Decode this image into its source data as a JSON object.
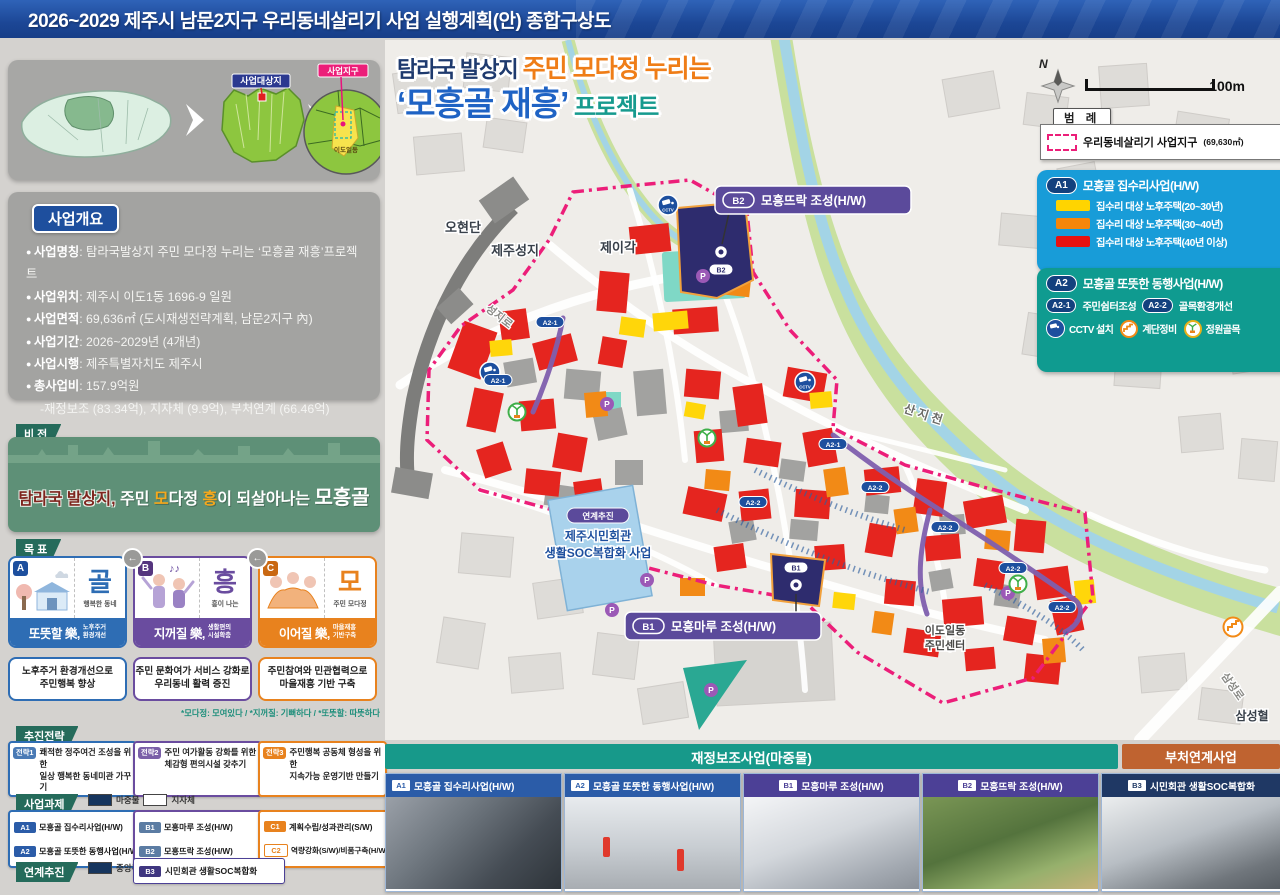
{
  "titlebar": {
    "title": "2026~2029  제주시 남문2지구 우리동네살리기 사업 실행계획(안) 종합구상도"
  },
  "insets": {
    "target_site_badge": "사업대상지",
    "district_badge": "사업지구",
    "dong_label": "이도일동"
  },
  "overview": {
    "header": "사업개요",
    "items": [
      {
        "label": "사업명칭",
        "value": ": 탐라국발상지 주민 모다정 누리는 ‘모흥골 재흥’프로젝트"
      },
      {
        "label": "사업위치",
        "value": ": 제주시 이도1동 1696-9 일원"
      },
      {
        "label": "사업면적",
        "value": ": 69,636㎡ (도시재생전략계획, 남문2지구 內)"
      },
      {
        "label": "사업기간",
        "value": ": 2026~2029년 (4개년)"
      },
      {
        "label": "사업시행",
        "value": ": 제주특별자치도 제주시"
      },
      {
        "label": "총사업비",
        "value": ": 157.9억원"
      }
    ],
    "breakdown": "-재정보조 (83.34억), 지자체 (9.9억), 부처연계 (66.46억)"
  },
  "vision": {
    "tag": "비 전",
    "p1": "탐라국 발상지,",
    "p2": " 주민 ",
    "p3": "모",
    "p4": "다정 ",
    "p5": "흥",
    "p6": "이 되살아나는 ",
    "p7": "모흥골"
  },
  "goals": {
    "tag": "목 표",
    "footnote": "*모다정: 모여있다 / *지꺼질: 기뻐하다 / *또뜻할: 따뜻하다",
    "arrow": "←",
    "cards": [
      {
        "letter": "A",
        "char": "골",
        "caption": "행복한 동네",
        "title": "또뜻할 樂,",
        "subtitle": "노후주거\n환경개선",
        "desc": "노후주거 환경개선으로\n주민행복 향상"
      },
      {
        "letter": "B",
        "char": "흥",
        "caption": "흥이 나는",
        "title": "지꺼질 樂,",
        "subtitle": "생활편의\n시설확충",
        "desc": "주민 문화여가 서비스 강화로\n우리동네 활력 증진"
      },
      {
        "letter": "C",
        "char": "모",
        "caption": "주민 모다정",
        "title": "이어질 樂,",
        "subtitle": "마을재흥\n기반구축",
        "desc": "주민참여와 민관협력으로\n마을재흥 기반 구축"
      }
    ]
  },
  "strategies": {
    "tag": "추진전략",
    "items": [
      {
        "badge": "전략1",
        "text": "쾌적한 정주여건 조성을 위한\n일상 행복한 동네미관 가꾸기"
      },
      {
        "badge": "전략2",
        "text": "주민 여가활동 강화를 위한\n체감형 편의시설 갖추기"
      },
      {
        "badge": "전략3",
        "text": "주민행복 공동체 형성을 위한\n지속가능 운영기반 만들기"
      }
    ]
  },
  "tasks": {
    "tag": "사업과제",
    "legend_seed": "마중물",
    "legend_local": "지자체",
    "groupA": [
      {
        "badge": "A1",
        "text": "모흥골 집수리사업(H/W)"
      },
      {
        "badge": "A2",
        "text": "모흥골 또뜻한 동행사업(H/W)"
      }
    ],
    "groupB": [
      {
        "badge": "B1",
        "text": "모흥마루 조성(H/W)"
      },
      {
        "badge": "B2",
        "text": "모흥뜨락 조성(H/W)"
      }
    ],
    "groupC": [
      {
        "badge": "C1",
        "text": "계획수립/성과관리(S/W)"
      },
      {
        "badge": "C2",
        "text": "역량강화(S/W)/비품구축(H/W)"
      }
    ],
    "linked_tag": "연계추진",
    "legend_central": "중앙부처",
    "linked_item": {
      "badge": "B3",
      "text": "시민회관 생활SOC복합화"
    }
  },
  "map": {
    "headline": {
      "pre": "탐라국 발상지 ",
      "hl": "주민 모다정 누리는",
      "main": "‘모흥골 재흥’",
      "tail": " 프로젝트"
    },
    "compass_n": "N",
    "scale_label": "100m",
    "legend": {
      "header": "범 례",
      "district_label": "우리동네살리기 사업지구",
      "district_area": "(69,630㎡)",
      "a1_badge": "A1",
      "a1_title": "모흥골 집수리사업(H/W)",
      "a1_items": [
        "집수리 대상 노후주택(20~30년)",
        "집수리 대상 노후주택(30~40년)",
        "집수리 대상 노후주택(40년 이상)"
      ],
      "a2_badge": "A2",
      "a2_title": "모흥골 또뜻한 동행사업(H/W)",
      "a2_sub1_badge": "A2-1",
      "a2_sub1": "주민쉼터조성",
      "a2_sub2_badge": "A2-2",
      "a2_sub2": "골목환경개선",
      "icon1": "CCTV 설치",
      "icon2": "계단정비",
      "icon3": "정원골목"
    },
    "labels": {
      "ohyeondan": "오현단",
      "fortress": "제주성지",
      "jeigak": "제이각",
      "seongjiro": "성지로",
      "sanjicheon": "산 지 천",
      "cc1": "이도일동",
      "cc2": "주민센터",
      "samseonghyeol": "삼성혈",
      "samseongro": "삼성로"
    },
    "callout_b2": {
      "badge": "B2",
      "label": "모흥뜨락 조성(H/W)"
    },
    "callout_b1": {
      "badge": "B1",
      "label": "모흥마루 조성(H/W)"
    },
    "linked_site": {
      "tag": "연계추진",
      "line1": "제주시민회관",
      "line2": "생활SOC복합화 사업"
    },
    "badges": {
      "a21": "A2-1",
      "a22": "A2-2",
      "cctv": "CCTV",
      "p": "P",
      "b1": "B1",
      "b2": "B2"
    }
  },
  "bottom": {
    "subsidy_header": "재정보조사업(마중물)",
    "ministry_header": "부처연계사업",
    "cards": [
      {
        "badge": "A1",
        "title": "모흥골 집수리사업(H/W)"
      },
      {
        "badge": "A2",
        "title": "모흥골 또뜻한 동행사업(H/W)"
      },
      {
        "badge": "B1",
        "title": "모흥마루 조성(H/W)"
      },
      {
        "badge": "B2",
        "title": "모흥뜨락 조성(H/W)"
      },
      {
        "badge": "B3",
        "title": "시민회관 생활SOC복합화"
      }
    ]
  },
  "colors": {
    "boundary_pink": "#ec1e79",
    "a1_panel_blue": "#189cd8",
    "a2_panel_teal": "#0f9b90",
    "grade_20_30": "#ffd400",
    "grade_30_40": "#f5860a",
    "grade_40plus": "#e8120f",
    "goal_a_blue": "#2e6db4",
    "goal_b_purple": "#6a4c9f",
    "goal_c_orange": "#e8821e"
  }
}
